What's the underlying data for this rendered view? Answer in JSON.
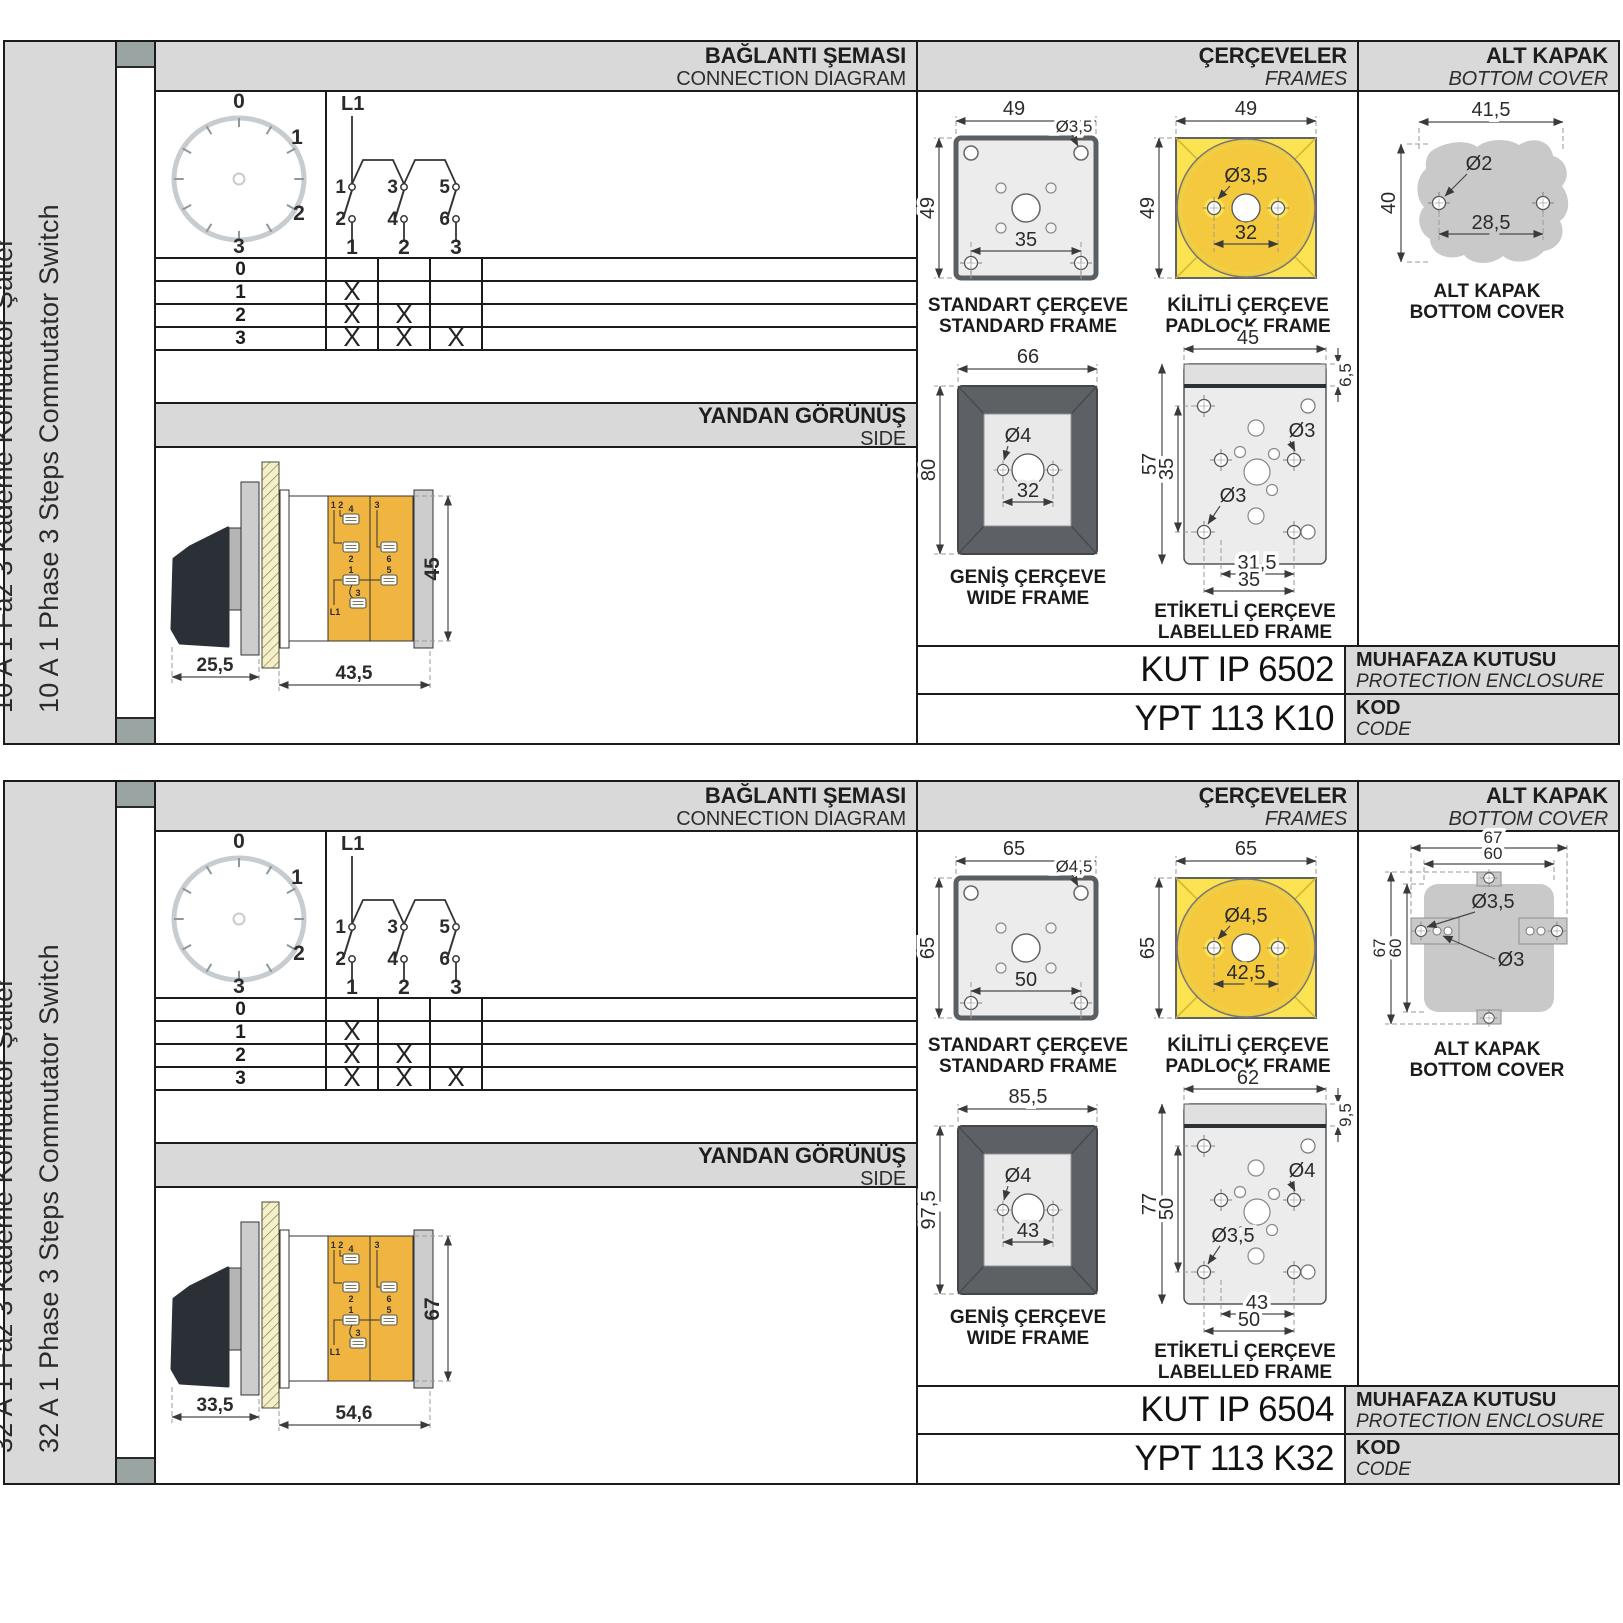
{
  "page": {
    "bg": "#ffffff",
    "accent_yellow": "#f5c93e",
    "panel_grey": "#d9d9d9"
  },
  "blocks": [
    {
      "label_tr": "10 A 1 Faz 3 Kademe Komütatör Şalter",
      "label_en": "10 A 1 Phase 3 Steps Commutator Switch",
      "connection": {
        "title_tr": "BAĞLANTI ŞEMASI",
        "title_en": "CONNECTION DIAGRAM",
        "dial": {
          "p0": "0",
          "p1": "1",
          "p2": "2",
          "p3": "3"
        },
        "schematic": {
          "feed": "L1",
          "t1": "1",
          "t3": "3",
          "t5": "5",
          "b2": "2",
          "b4": "4",
          "b6": "6",
          "o1": "1",
          "o2": "2",
          "o3": "3"
        },
        "table": {
          "rows": [
            {
              "label": "0",
              "c1": "",
              "c2": "",
              "c3": ""
            },
            {
              "label": "1",
              "c1": "X",
              "c2": "",
              "c3": ""
            },
            {
              "label": "2",
              "c1": "X",
              "c2": "X",
              "c3": ""
            },
            {
              "label": "3",
              "c1": "X",
              "c2": "X",
              "c3": "X"
            }
          ]
        }
      },
      "side": {
        "title_tr": "YANDAN GÖRÜNÜŞ",
        "title_en": "SIDE",
        "dim_front": "25,5",
        "dim_body": "43,5",
        "dim_height": "45",
        "t_pair": "1 2",
        "t4": "4",
        "t2": "2",
        "t3_top": "3",
        "t6": "6",
        "t1": "1",
        "t5": "5",
        "t3": "3",
        "feed": "L1"
      },
      "frames": {
        "title_tr": "ÇERÇEVELER",
        "title_en": "FRAMES",
        "standard": {
          "w": "49",
          "h": "49",
          "hole": "Ø3,5",
          "pitch": "35",
          "cap_tr": "STANDART ÇERÇEVE",
          "cap_en": "STANDARD FRAME"
        },
        "padlock": {
          "w": "49",
          "h": "49",
          "hole": "Ø3,5",
          "pitch": "32",
          "cap_tr": "KİLİTLİ ÇERÇEVE",
          "cap_en": "PADLOCK FRAME"
        },
        "wide": {
          "w": "66",
          "h": "80",
          "hole": "Ø4",
          "pitch": "32",
          "cap_tr": "GENİŞ ÇERÇEVE",
          "cap_en": "WIDE FRAME"
        },
        "labelled": {
          "w": "45",
          "strip": "6,5",
          "h": "57",
          "pitch_v": "35",
          "hole_r": "Ø3",
          "hole_l": "Ø3",
          "pitch_b1": "31,5",
          "pitch_b2": "35",
          "cap_tr": "ETİKETLİ ÇERÇEVE",
          "cap_en": "LABELLED FRAME"
        }
      },
      "cover": {
        "title_tr": "ALT KAPAK",
        "title_en": "BOTTOM COVER",
        "cap_tr": "ALT KAPAK",
        "cap_en": "BOTTOM COVER",
        "v1": {
          "w": "41,5",
          "h": "40",
          "hole": "Ø2",
          "pitch": "28,5"
        }
      },
      "codes": {
        "enclosure": "KUT IP 6502",
        "enc_tr": "MUHAFAZA KUTUSU",
        "enc_en": "PROTECTION ENCLOSURE",
        "code": "YPT 113 K10",
        "code_tr": "KOD",
        "code_en": "CODE"
      }
    },
    {
      "label_tr": "32 A 1 Faz 3 Kademe Komütatör Şalter",
      "label_en": "32 A 1 Phase 3 Steps Commutator Switch",
      "connection": {
        "title_tr": "BAĞLANTI ŞEMASI",
        "title_en": "CONNECTION DIAGRAM",
        "dial": {
          "p0": "0",
          "p1": "1",
          "p2": "2",
          "p3": "3"
        },
        "schematic": {
          "feed": "L1",
          "t1": "1",
          "t3": "3",
          "t5": "5",
          "b2": "2",
          "b4": "4",
          "b6": "6",
          "o1": "1",
          "o2": "2",
          "o3": "3"
        },
        "table": {
          "rows": [
            {
              "label": "0",
              "c1": "",
              "c2": "",
              "c3": ""
            },
            {
              "label": "1",
              "c1": "X",
              "c2": "",
              "c3": ""
            },
            {
              "label": "2",
              "c1": "X",
              "c2": "X",
              "c3": ""
            },
            {
              "label": "3",
              "c1": "X",
              "c2": "X",
              "c3": "X"
            }
          ]
        }
      },
      "side": {
        "title_tr": "YANDAN GÖRÜNÜŞ",
        "title_en": "SIDE",
        "dim_front": "33,5",
        "dim_body": "54,6",
        "dim_height": "67",
        "t_pair": "1 2",
        "t4": "4",
        "t2": "2",
        "t3_top": "3",
        "t6": "6",
        "t1": "1",
        "t5": "5",
        "t3": "3",
        "feed": "L1"
      },
      "frames": {
        "title_tr": "ÇERÇEVELER",
        "title_en": "FRAMES",
        "standard": {
          "w": "65",
          "h": "65",
          "hole": "Ø4,5",
          "pitch": "50",
          "cap_tr": "STANDART ÇERÇEVE",
          "cap_en": "STANDARD FRAME"
        },
        "padlock": {
          "w": "65",
          "h": "65",
          "hole": "Ø4,5",
          "pitch": "42,5",
          "cap_tr": "KİLİTLİ ÇERÇEVE",
          "cap_en": "PADLOCK FRAME"
        },
        "wide": {
          "w": "85,5",
          "h": "97,5",
          "hole": "Ø4",
          "pitch": "43",
          "cap_tr": "GENİŞ ÇERÇEVE",
          "cap_en": "WIDE FRAME"
        },
        "labelled": {
          "w": "62",
          "strip": "9,5",
          "h": "77",
          "pitch_v": "50",
          "hole_r": "Ø4",
          "hole_l": "Ø3,5",
          "pitch_b1": "43",
          "pitch_b2": "50",
          "cap_tr": "ETİKETLİ ÇERÇEVE",
          "cap_en": "LABELLED FRAME"
        }
      },
      "cover": {
        "title_tr": "ALT KAPAK",
        "title_en": "BOTTOM COVER",
        "cap_tr": "ALT KAPAK",
        "cap_en": "BOTTOM COVER",
        "v2": {
          "w1": "67",
          "w2": "60",
          "h1": "67",
          "h2": "60",
          "hole1": "Ø3,5",
          "hole2": "Ø3"
        }
      },
      "codes": {
        "enclosure": "KUT IP 6504",
        "enc_tr": "MUHAFAZA KUTUSU",
        "enc_en": "PROTECTION ENCLOSURE",
        "code": "YPT 113 K32",
        "code_tr": "KOD",
        "code_en": "CODE"
      }
    }
  ]
}
